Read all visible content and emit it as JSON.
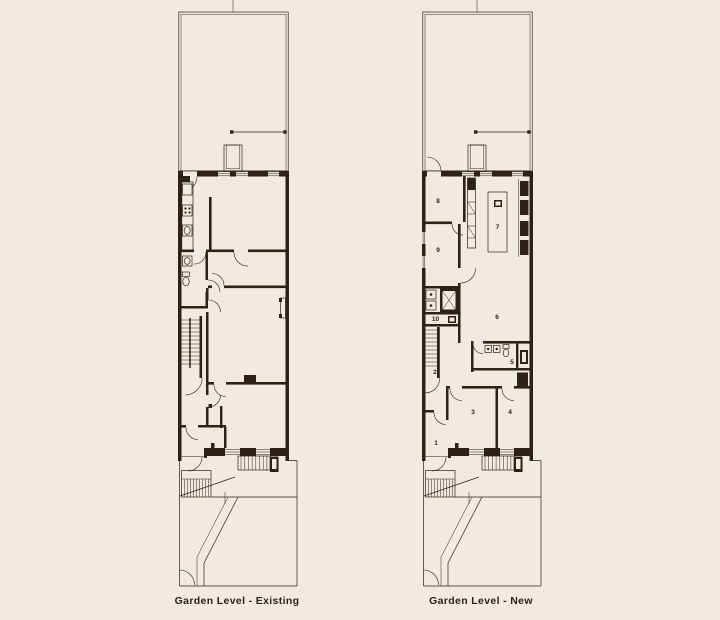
{
  "page": {
    "background": "#f2eae1",
    "ink": "#2e2118"
  },
  "plans": {
    "existing": {
      "caption": "Garden Level - Existing"
    },
    "new": {
      "caption": "Garden Level - New",
      "rooms": [
        {
          "number": "1",
          "x": 14,
          "y": 445
        },
        {
          "number": "2",
          "x": 13,
          "y": 374
        },
        {
          "number": "3",
          "x": 51,
          "y": 414
        },
        {
          "number": "4",
          "x": 88,
          "y": 414
        },
        {
          "number": "5",
          "x": 90,
          "y": 364
        },
        {
          "number": "6",
          "x": 75,
          "y": 319
        },
        {
          "number": "7",
          "x": 75.5,
          "y": 229
        },
        {
          "number": "8",
          "x": 16,
          "y": 203
        },
        {
          "number": "9",
          "x": 16,
          "y": 252
        },
        {
          "number": "10",
          "x": 13.5,
          "y": 321
        }
      ]
    }
  }
}
